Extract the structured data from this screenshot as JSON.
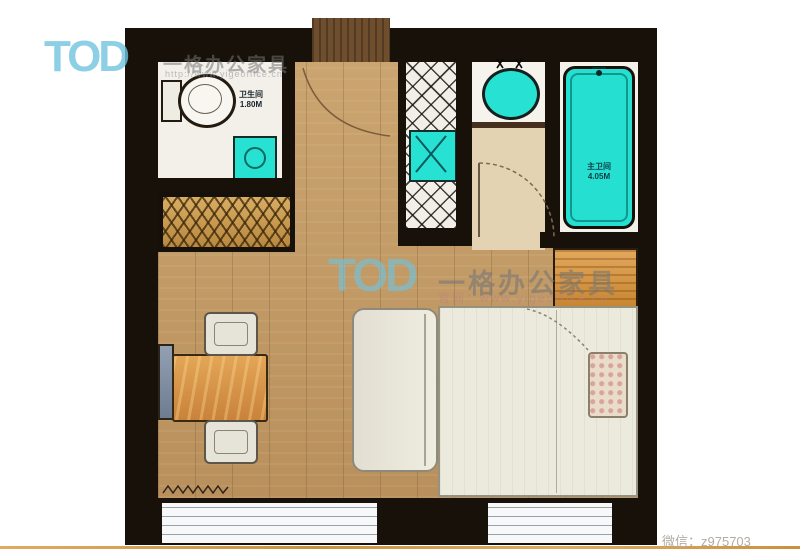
{
  "watermarks": {
    "top_left": {
      "logo": "TOD",
      "brand": "一格办公家具",
      "url": "http://www.yigeoffice.cn"
    },
    "center": {
      "logo": "TOD",
      "brand": "一格办公家具",
      "site": "官网：www.yigeoffice.cn"
    }
  },
  "footer": {
    "wechat": "微信：z975703"
  },
  "plan": {
    "labels": {
      "bathroom": {
        "name": "卫生间",
        "area": "1.80M"
      },
      "master_bath": {
        "name": "主卫间",
        "area": "4.05M"
      }
    },
    "colors": {
      "wall": "#17110a",
      "wood_floor": "#c49a66",
      "fixture_cyan": "#25e0d1",
      "wardrobe_gold": "#c49444",
      "desk_wood": "#d2944a",
      "logo_blue": "#71c4e0",
      "bottom_line": "#d89e52"
    }
  }
}
